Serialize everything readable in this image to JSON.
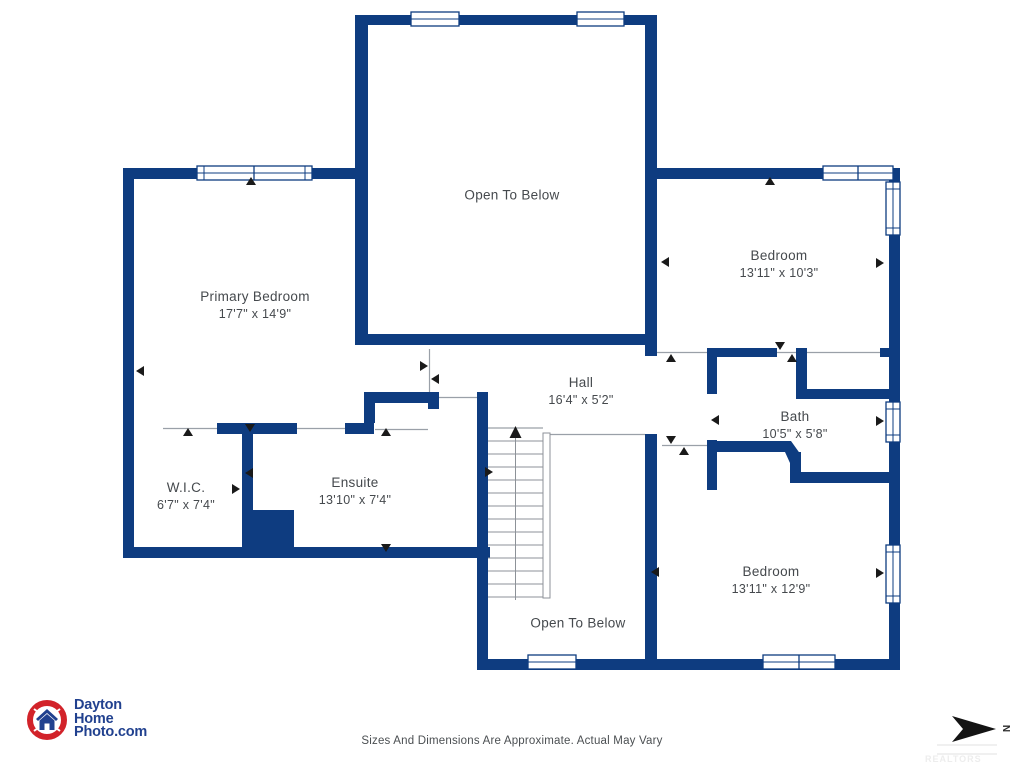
{
  "colors": {
    "wall_navy": "#0e3c80",
    "label_text": "#45494d",
    "thin_line_gray": "#9aa0a8",
    "stair_line_gray": "#8d9298",
    "marker_black": "#1a1a1a",
    "logo_red": "#d2232a",
    "logo_navy": "#21418f",
    "disclaimer_gray": "#4b4f52"
  },
  "rooms": {
    "open_above": {
      "name": "Open To Below"
    },
    "primary": {
      "name": "Primary Bedroom",
      "dims": "17'7\" x 14'9\""
    },
    "bedroom1": {
      "name": "Bedroom",
      "dims": "13'11\" x 10'3\""
    },
    "hall": {
      "name": "Hall",
      "dims": "16'4\" x 5'2\""
    },
    "bath": {
      "name": "Bath",
      "dims": "10'5\" x 5'8\""
    },
    "wic": {
      "name": "W.I.C.",
      "dims": "6'7\" x 7'4\""
    },
    "ensuite": {
      "name": "Ensuite",
      "dims": "13'10\" x 7'4\""
    },
    "bedroom2": {
      "name": "Bedroom",
      "dims": "13'11\" x 12'9\""
    },
    "open_below": {
      "name": "Open To Below"
    }
  },
  "footer": {
    "disclaimer": "Sizes And Dimensions Are Approximate. Actual May Vary"
  },
  "logo": {
    "line1": "Dayton",
    "line2": "Home",
    "line3": "Photo.com"
  },
  "compass": {
    "label": "N"
  },
  "watermark": {
    "text": "REALTORS"
  }
}
